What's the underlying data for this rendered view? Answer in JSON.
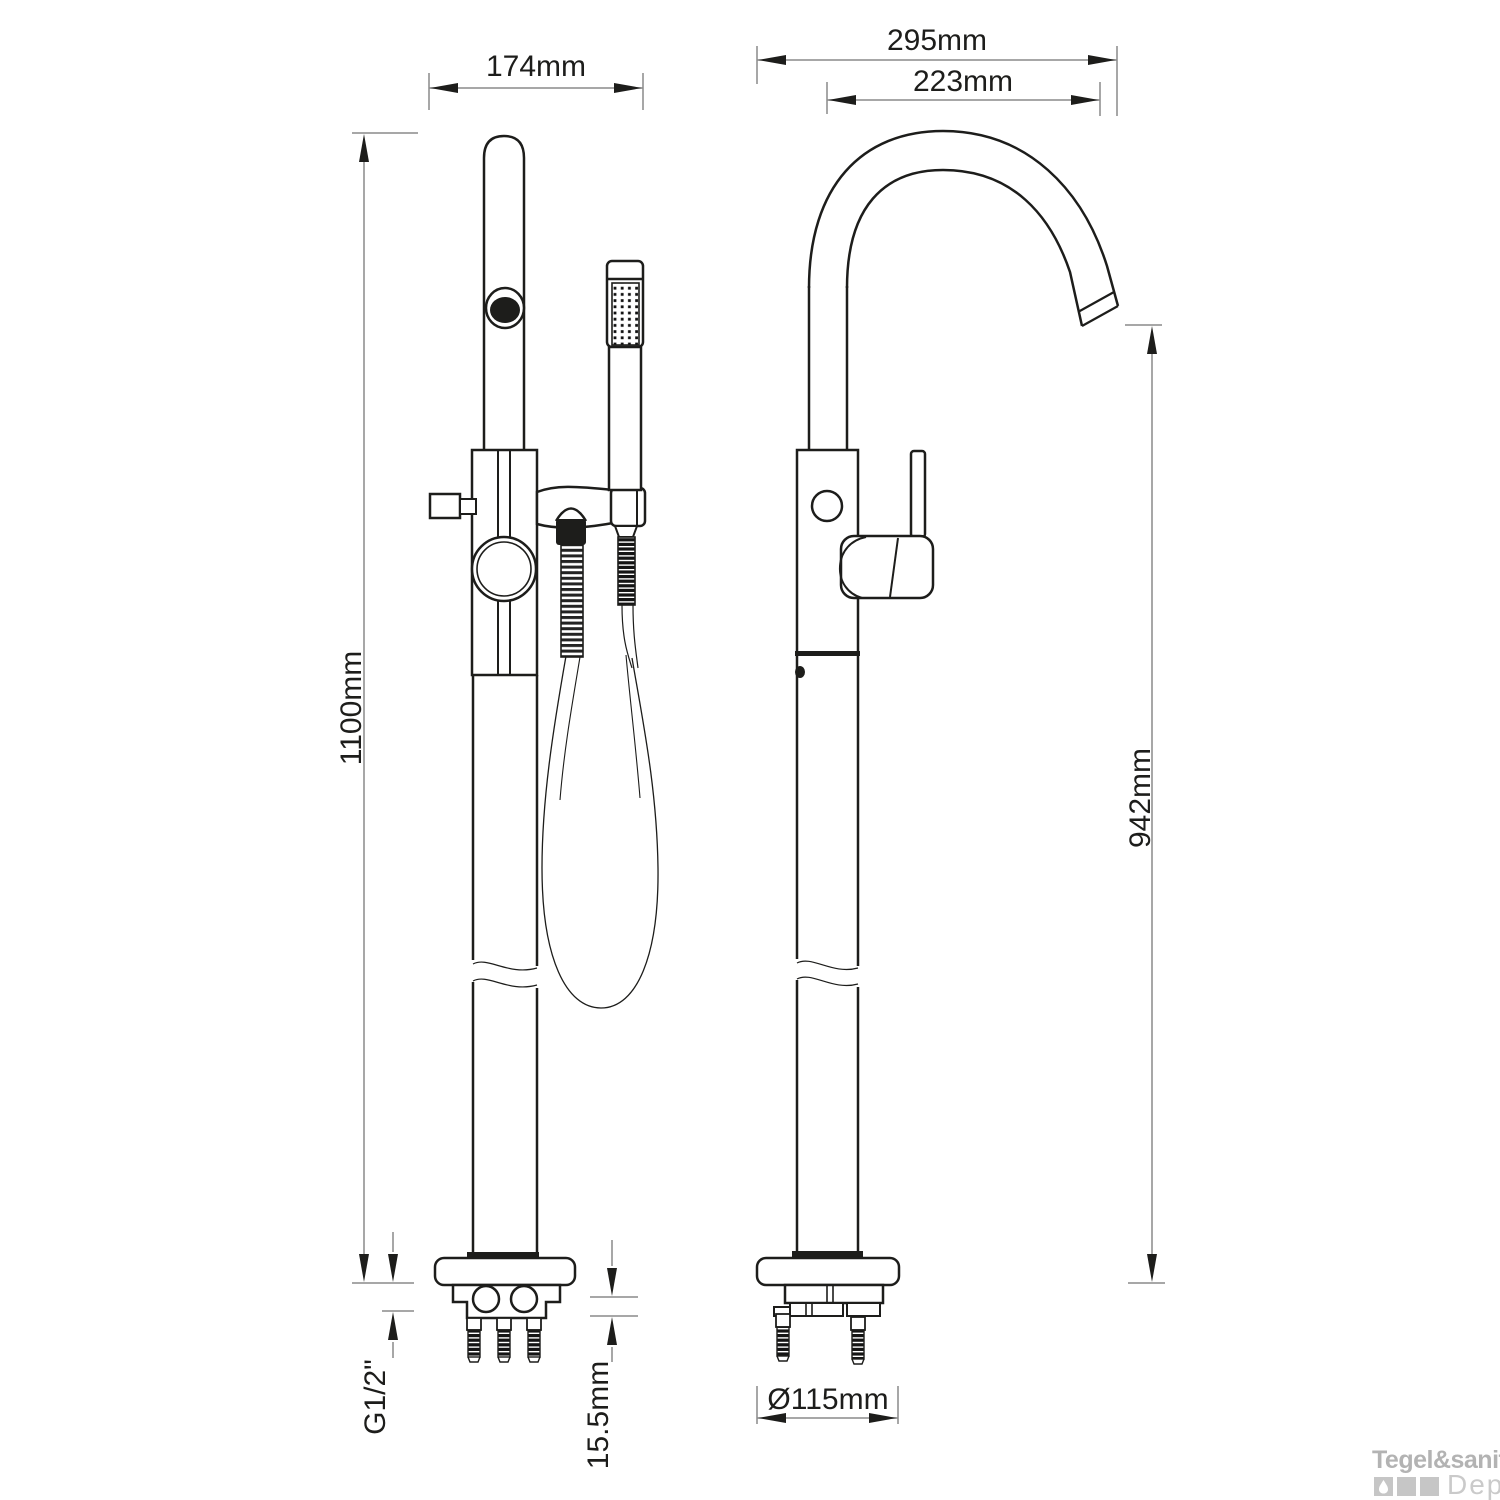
{
  "drawing": {
    "dimensions": {
      "front_overall_width": "174mm",
      "side_overall_depth": "295mm",
      "spout_reach": "223mm",
      "total_height": "1100mm",
      "spout_height": "942mm",
      "connection_thread": "G1/2\"",
      "base_plate_thickness": "15.5mm",
      "base_diameter": "Ø115mm"
    },
    "colors": {
      "ink": "#1d1d1b",
      "dim_line_gray": "#8a8a8a",
      "watermark_gray": "#b3b3b3",
      "watermark_light": "#cacaca"
    }
  },
  "watermark": {
    "brand_bold": "Tegel&sanitair",
    "brand_light": "Depot"
  }
}
